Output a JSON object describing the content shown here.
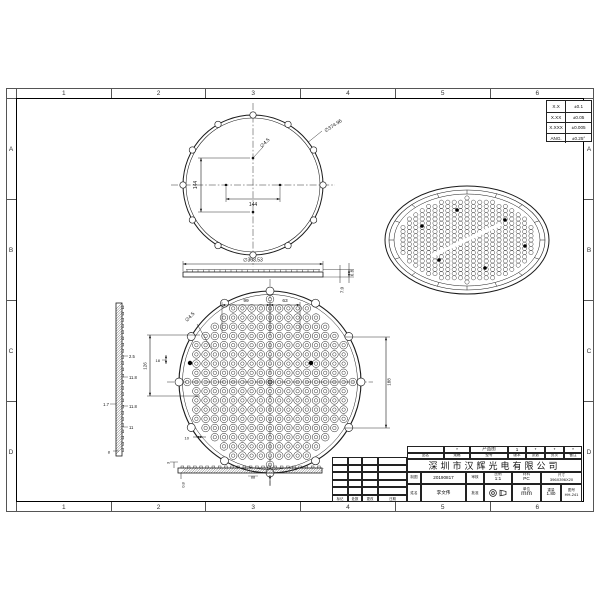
{
  "sheet": {
    "zones_h": [
      "1",
      "2",
      "3",
      "4",
      "5",
      "6"
    ],
    "zones_v": [
      "A",
      "B",
      "C",
      "D"
    ]
  },
  "tolerance_table": {
    "rows": [
      {
        "k": "X.X",
        "v": "±0.1"
      },
      {
        "k": "X.XX",
        "v": "±0.05"
      },
      {
        "k": "X.XXX",
        "v": "±0.005"
      },
      {
        "k": "ANG.",
        "v": "±0.25°"
      }
    ]
  },
  "views": {
    "front": {
      "dia": "∅374.96",
      "hole": "∅4.5",
      "pitch_h": "144",
      "pitch_v": "144"
    },
    "profile": {
      "dia": "∅363.53",
      "h_step": "6.8",
      "h_total": "7.0"
    },
    "lens": {
      "hole": "∅4.5",
      "d_left": "99",
      "d_right": "63",
      "d_126": "126",
      "d_18": "18",
      "d_10": "10",
      "d_188": "188"
    },
    "left_section": {
      "d1": "2.5",
      "d2": "11.8",
      "d3": "11.8",
      "d4": "1.7",
      "d5": "11",
      "d6": "8"
    },
    "bottom_section": {
      "d1": "3",
      "d2": "0.8",
      "d3": "88"
    }
  },
  "title_block": {
    "product_mark": "*",
    "product_label": "产品图",
    "r1": [
      "1",
      "*",
      "*",
      "*"
    ],
    "r2_labels": [
      "品名",
      "规格",
      "型号",
      "版本",
      "张数",
      "页次",
      "备注"
    ],
    "company": "深圳市汉辉光电有限公司",
    "drawn_label": "制图",
    "date": "20190817",
    "checked_label": "审核",
    "scale_label": "比例",
    "scale": "1:1",
    "material_label": "材料",
    "material": "PC",
    "size_label": "尺寸",
    "size": "396X396X20",
    "name_label": "姓名",
    "name": "李文伟",
    "approved_label": "批准",
    "angle_label": "角法",
    "unit_label": "单位",
    "unit": "mm",
    "weight_label": "重量",
    "weight": "1.80",
    "dwg_label": "图号",
    "dwg_no": "HH-241",
    "rev_headers": [
      "标记",
      "处数",
      "更改",
      "日期"
    ]
  }
}
